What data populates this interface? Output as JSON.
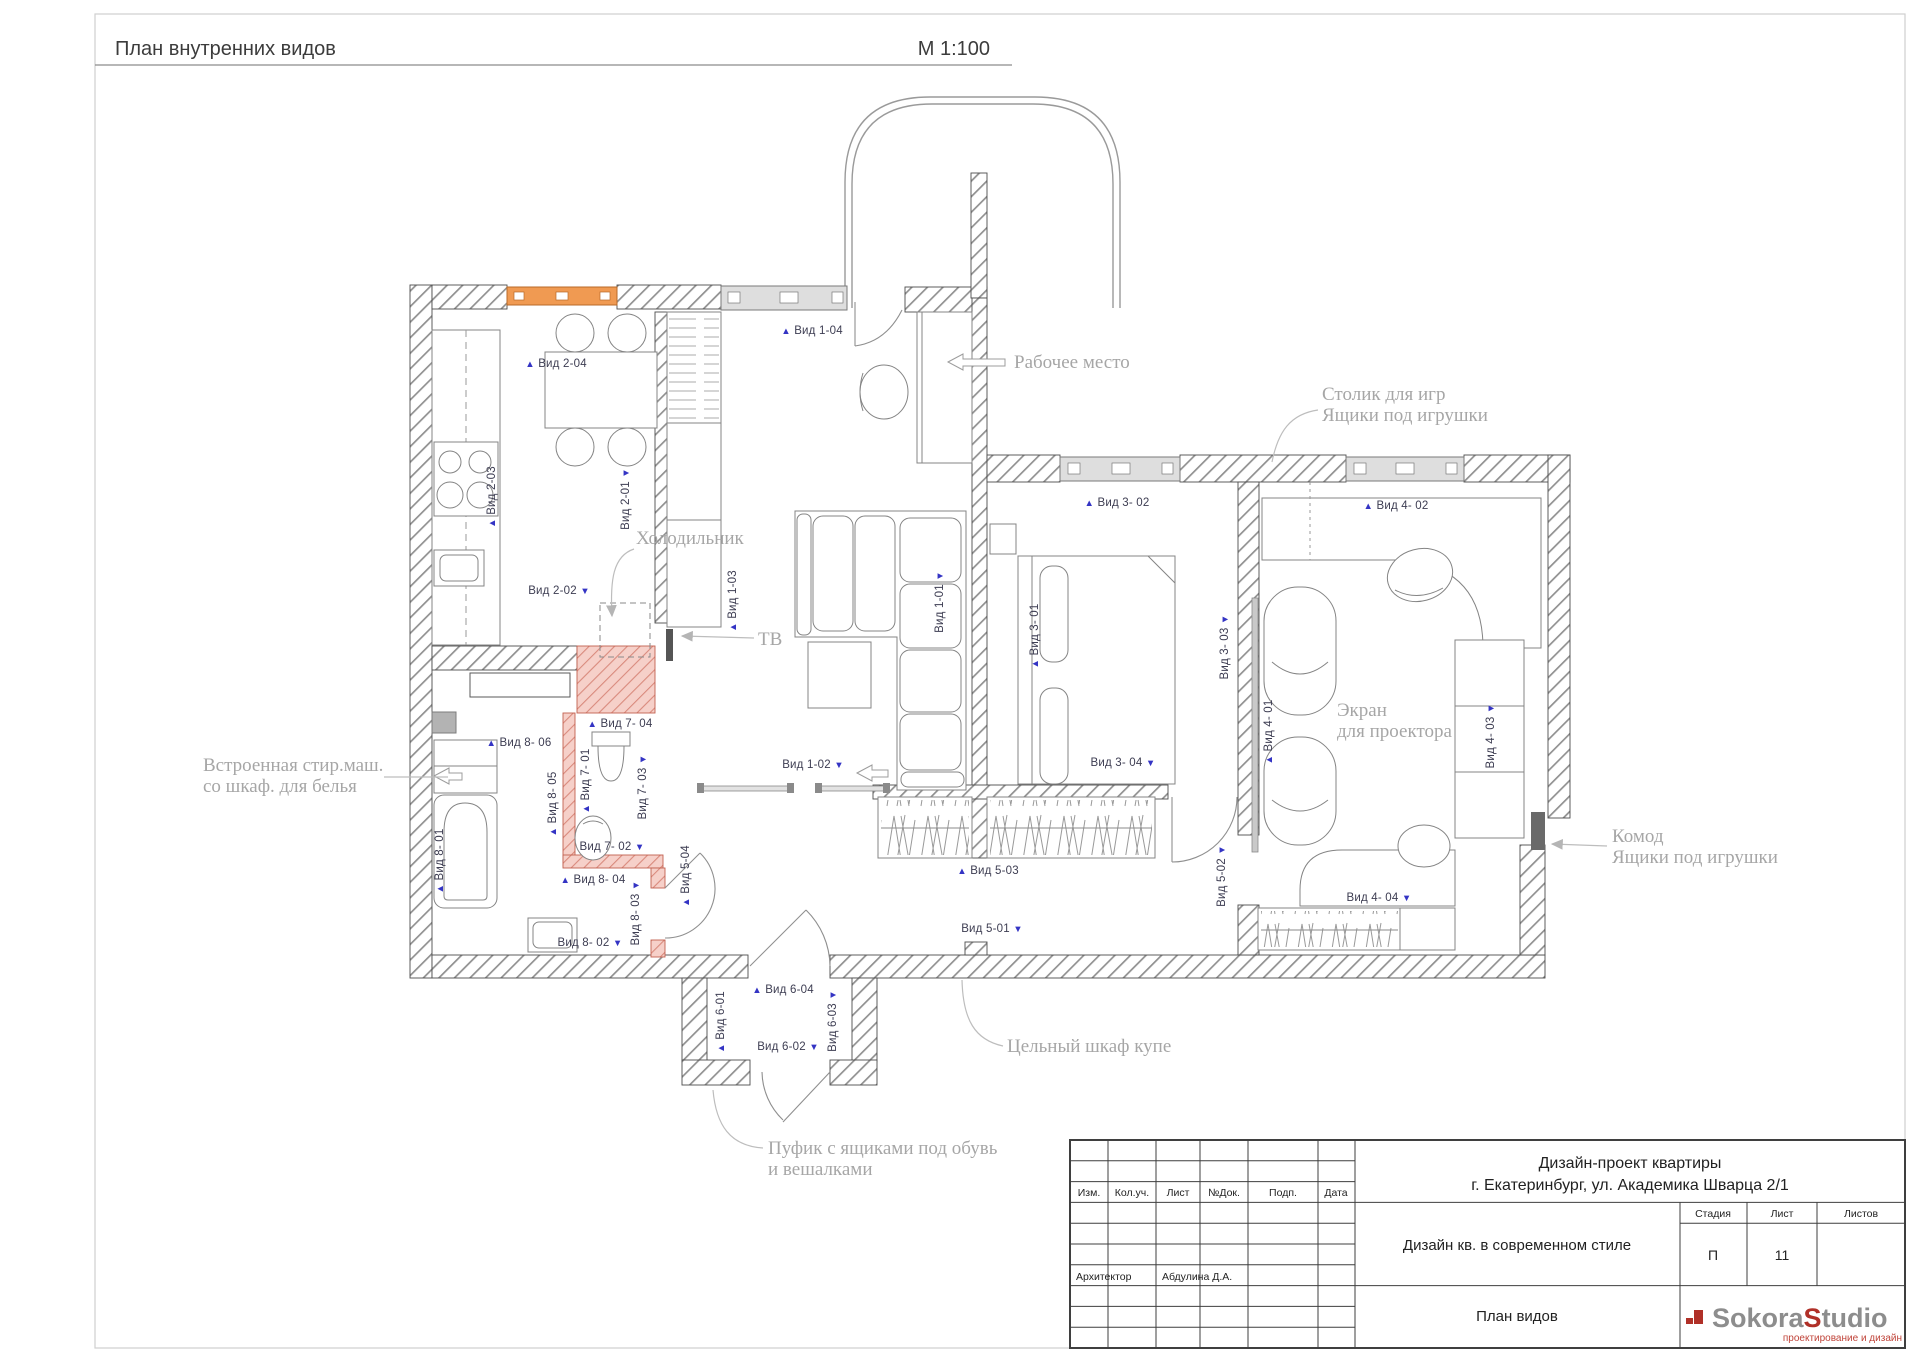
{
  "header": {
    "title": "План внутренних видов",
    "scale": "М 1:100"
  },
  "plan": {
    "colors": {
      "wall_hatch": "#8f8f8f",
      "new_wall_fill": "#f6d0c9",
      "new_wall_line": "#d98a7d",
      "window_orange": "#f09a52",
      "label_blue": "#3434c4",
      "annotation_gray": "#a6a6a6"
    },
    "view_labels": [
      {
        "text": "Вид 1-04",
        "x": 812,
        "y": 334,
        "vertical": false,
        "marker": "▲",
        "marker_pos": "before"
      },
      {
        "text": "Вид 2-04",
        "x": 556,
        "y": 367,
        "vertical": false,
        "marker": "▲",
        "marker_pos": "before"
      },
      {
        "text": "Вид 3- 02",
        "x": 1117,
        "y": 506,
        "vertical": false,
        "marker": "▲",
        "marker_pos": "before"
      },
      {
        "text": "Вид 4- 02",
        "x": 1396,
        "y": 509,
        "vertical": false,
        "marker": "▲",
        "marker_pos": "before"
      },
      {
        "text": "Вид 7- 04",
        "x": 620,
        "y": 727,
        "vertical": false,
        "marker": "▲",
        "marker_pos": "before"
      },
      {
        "text": "Вид 8- 06",
        "x": 519,
        "y": 746,
        "vertical": false,
        "marker": "▲",
        "marker_pos": "before"
      },
      {
        "text": "Вид 8- 04",
        "x": 593,
        "y": 883,
        "vertical": false,
        "marker": "▲",
        "marker_pos": "before"
      },
      {
        "text": "Вид 5-03",
        "x": 988,
        "y": 874,
        "vertical": false,
        "marker": "▲",
        "marker_pos": "before"
      },
      {
        "text": "Вид 6-04",
        "x": 783,
        "y": 993,
        "vertical": false,
        "marker": "▲",
        "marker_pos": "before"
      },
      {
        "text": "Вид 2-02",
        "x": 559,
        "y": 594,
        "vertical": false,
        "marker": "▼",
        "marker_pos": "after"
      },
      {
        "text": "Вид 3- 04",
        "x": 1123,
        "y": 766,
        "vertical": false,
        "marker": "▼",
        "marker_pos": "after"
      },
      {
        "text": "Вид 1-02",
        "x": 813,
        "y": 768,
        "vertical": false,
        "marker": "▼",
        "marker_pos": "after"
      },
      {
        "text": "Вид 7- 02",
        "x": 612,
        "y": 850,
        "vertical": false,
        "marker": "▼",
        "marker_pos": "after"
      },
      {
        "text": "Вид 8- 02",
        "x": 590,
        "y": 946,
        "vertical": false,
        "marker": "▼",
        "marker_pos": "after"
      },
      {
        "text": "Вид 5-01",
        "x": 992,
        "y": 932,
        "vertical": false,
        "marker": "▼",
        "marker_pos": "after"
      },
      {
        "text": "Вид 4- 04",
        "x": 1379,
        "y": 901,
        "vertical": false,
        "marker": "▼",
        "marker_pos": "after"
      },
      {
        "text": "Вид 6-02",
        "x": 788,
        "y": 1050,
        "vertical": false,
        "marker": "▼",
        "marker_pos": "after"
      },
      {
        "text": "Вид 2-03",
        "x": 495,
        "y": 497,
        "vertical": true,
        "marker": "▲",
        "marker_pos": "before"
      },
      {
        "text": "Вид 1-03",
        "x": 736,
        "y": 601,
        "vertical": true,
        "marker": "▲",
        "marker_pos": "before"
      },
      {
        "text": "Вид 3- 01",
        "x": 1038,
        "y": 636,
        "vertical": true,
        "marker": "▲",
        "marker_pos": "before"
      },
      {
        "text": "Вид 4- 01",
        "x": 1272,
        "y": 732,
        "vertical": true,
        "marker": "▲",
        "marker_pos": "before"
      },
      {
        "text": "Вид 8- 01",
        "x": 443,
        "y": 861,
        "vertical": true,
        "marker": "▲",
        "marker_pos": "before"
      },
      {
        "text": "Вид 8- 05",
        "x": 556,
        "y": 804,
        "vertical": true,
        "marker": "▲",
        "marker_pos": "before"
      },
      {
        "text": "Вид 7- 01",
        "x": 589,
        "y": 781,
        "vertical": true,
        "marker": "▲",
        "marker_pos": "before"
      },
      {
        "text": "Вид 5-04",
        "x": 689,
        "y": 876,
        "vertical": true,
        "marker": "▲",
        "marker_pos": "before"
      },
      {
        "text": "Вид 6-01",
        "x": 724,
        "y": 1022,
        "vertical": true,
        "marker": "▲",
        "marker_pos": "before"
      },
      {
        "text": "Вид 2-01",
        "x": 629,
        "y": 499,
        "vertical": true,
        "marker": "▼",
        "marker_pos": "after"
      },
      {
        "text": "Вид 1-01",
        "x": 943,
        "y": 602,
        "vertical": true,
        "marker": "▼",
        "marker_pos": "after"
      },
      {
        "text": "Вид 3- 03",
        "x": 1228,
        "y": 647,
        "vertical": true,
        "marker": "▼",
        "marker_pos": "after"
      },
      {
        "text": "Вид 4- 03",
        "x": 1494,
        "y": 736,
        "vertical": true,
        "marker": "▼",
        "marker_pos": "after"
      },
      {
        "text": "Вид 7- 03",
        "x": 646,
        "y": 787,
        "vertical": true,
        "marker": "▼",
        "marker_pos": "after"
      },
      {
        "text": "Вид 8- 03",
        "x": 639,
        "y": 913,
        "vertical": true,
        "marker": "▼",
        "marker_pos": "after"
      },
      {
        "text": "Вид 5-02",
        "x": 1225,
        "y": 876,
        "vertical": true,
        "marker": "▼",
        "marker_pos": "after"
      },
      {
        "text": "Вид 6-03",
        "x": 836,
        "y": 1021,
        "vertical": true,
        "marker": "▼",
        "marker_pos": "after"
      }
    ],
    "annotations": [
      {
        "x": 1014,
        "y": 368,
        "lines": [
          "Рабочее место"
        ]
      },
      {
        "x": 1322,
        "y": 400,
        "lines": [
          "Столик для игр",
          "Ящики под игрушки"
        ]
      },
      {
        "x": 636,
        "y": 544,
        "lines": [
          "Холодильник"
        ]
      },
      {
        "x": 758,
        "y": 645,
        "lines": [
          "ТВ"
        ]
      },
      {
        "x": 203,
        "y": 771,
        "lines": [
          "Встроенная стир.маш.",
          "со шкаф. для белья"
        ]
      },
      {
        "x": 1337,
        "y": 716,
        "lines": [
          "Экран",
          "для проектора"
        ]
      },
      {
        "x": 1612,
        "y": 842,
        "lines": [
          "Комод",
          "Ящики под игрушки"
        ]
      },
      {
        "x": 1007,
        "y": 1052,
        "lines": [
          "Цельный шкаф купе"
        ]
      },
      {
        "x": 768,
        "y": 1154,
        "lines": [
          "Пуфик с ящиками под обувь",
          "и вешалками"
        ]
      }
    ]
  },
  "title_block": {
    "project_line1": "Дизайн-проект квартиры",
    "project_line2": "г. Екатеринбург, ул. Академика Шварца 2/1",
    "columns": [
      "Изм.",
      "Кол.уч.",
      "Лист",
      "№Док.",
      "Подп.",
      "Дата"
    ],
    "doc_title": "Дизайн кв. в современном стиле",
    "stage_label": "Стадия",
    "sheet_label": "Лист",
    "sheets_label": "Листов",
    "stage": "П",
    "sheet": "11",
    "sheets": "",
    "role": "Архитектор",
    "architect": "Абдулина Д.А.",
    "drawing_name": "План видов",
    "logo": {
      "part1": "Sokora",
      "part2_first": "S",
      "part2_rest": "tudio",
      "tagline": "проектирование и дизайн"
    }
  }
}
